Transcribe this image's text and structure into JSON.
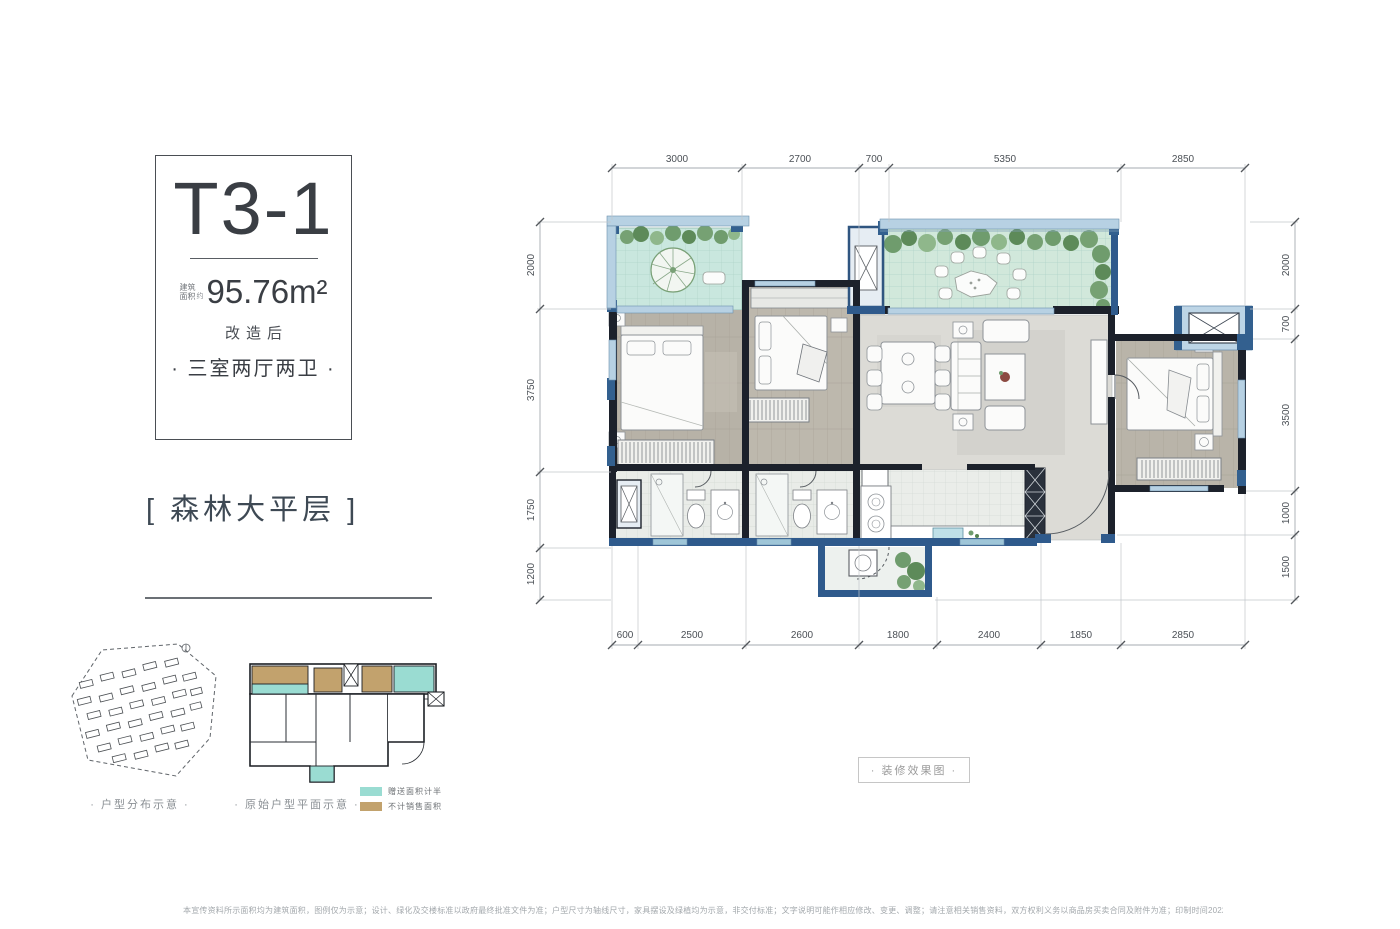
{
  "info_card": {
    "unit_name": "T3-1",
    "area_prefix_line1": "建筑",
    "area_prefix_line2": "面积",
    "area_approx": "约",
    "area_value": "95.76m²",
    "renovated_label": "改造后",
    "layout_label": "· 三室两厅两卫 ·"
  },
  "tagline": "[ 森林大平层 ]",
  "floor_plan": {
    "dims_top": [
      "3000",
      "2700",
      "700",
      "5350",
      "2850"
    ],
    "dims_bottom": [
      "600",
      "2500",
      "2600",
      "1800",
      "2400",
      "1850",
      "2850"
    ],
    "dims_left": [
      "2000",
      "3750",
      "1750",
      "1200"
    ],
    "dims_right": [
      "2000",
      "700",
      "3500",
      "1000",
      "1500"
    ],
    "decor_label": "· 装修效果图 ·"
  },
  "minis": {
    "site_label": "· 户型分布示意 ·",
    "original_label": "· 原始户型平面示意 ·",
    "legend": [
      {
        "swatch": "#9adcd2",
        "label": "赠送面积计半"
      },
      {
        "swatch": "#c2a26d",
        "label": "不计销售面积"
      }
    ]
  },
  "colors": {
    "wall_dark": "#1c212b",
    "wall_blue": "#33608f",
    "window_blue": "#b7d1e3",
    "balcony_teal": "#c9e7de",
    "terrace_green": "#d1e8db",
    "wood_floor": "#b7b2a7",
    "living_floor": "#dcdbd6",
    "plant_green": "#6f9c6d"
  },
  "disclaimer": "本宣传资料所示面积均为建筑面积，图例仅为示意；设计、绿化及交楼标准以政府最终批准文件为准；户型尺寸为轴线尺寸，家具摆设及绿植均为示意，非交付标准；文字说明可能作相应修改、变更、调整；请注意相关销售资料，双方权利义务以商品房买卖合同及附件为准；印制时间2022年2月，下同。"
}
